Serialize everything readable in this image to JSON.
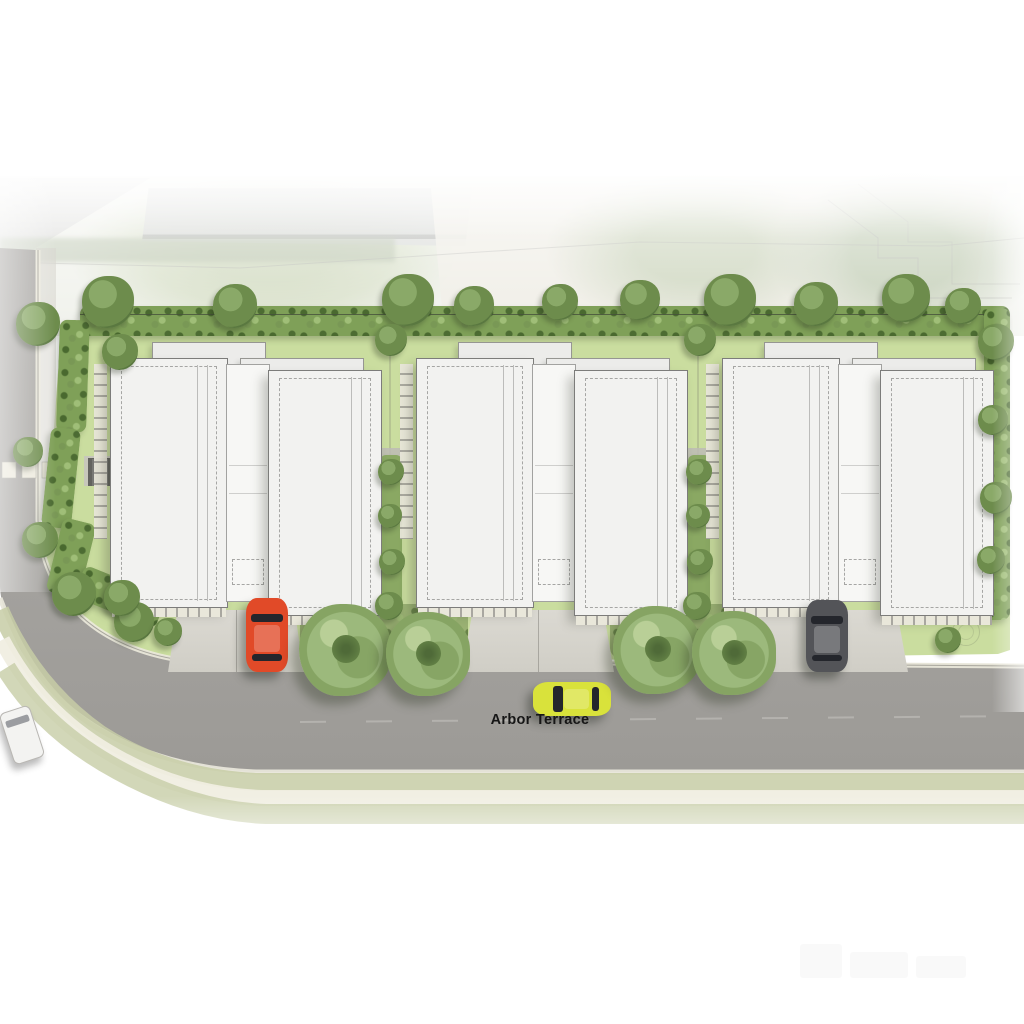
{
  "street": {
    "label": "Arbor Terrace"
  },
  "scene": {
    "type": "residential-site-plan-render",
    "blocks": [
      {
        "name": "townhouse-block-1"
      },
      {
        "name": "townhouse-block-2"
      },
      {
        "name": "townhouse-block-3"
      }
    ],
    "vehicles": [
      {
        "name": "red-car",
        "color": "#e14a28",
        "parked_on": "driveway-1"
      },
      {
        "name": "grey-car",
        "color": "#535458",
        "parked_on": "driveway-3"
      },
      {
        "name": "yellow-car",
        "color": "#d9e23b",
        "parked_on": "street"
      },
      {
        "name": "white-van",
        "color": "#f3f3f1",
        "parked_on": "street-left"
      }
    ]
  },
  "colors": {
    "lawn": "#cadd9f",
    "hedge": "#7fa058",
    "canopy": "#9cb97c",
    "road": "#a8a6a3",
    "curb": "#ece9db",
    "path": "#f0eee2",
    "vergeGrass": "#c7cda6",
    "roof": "#f2f2f0",
    "roofLine": "#7c7c7a",
    "roofDash": "#a6a6a4",
    "connector": "#f7f7f5",
    "rearBlock": "#ececea",
    "drive": "#d8d6cf",
    "paver": "#e9e7da",
    "label": "#161616"
  }
}
